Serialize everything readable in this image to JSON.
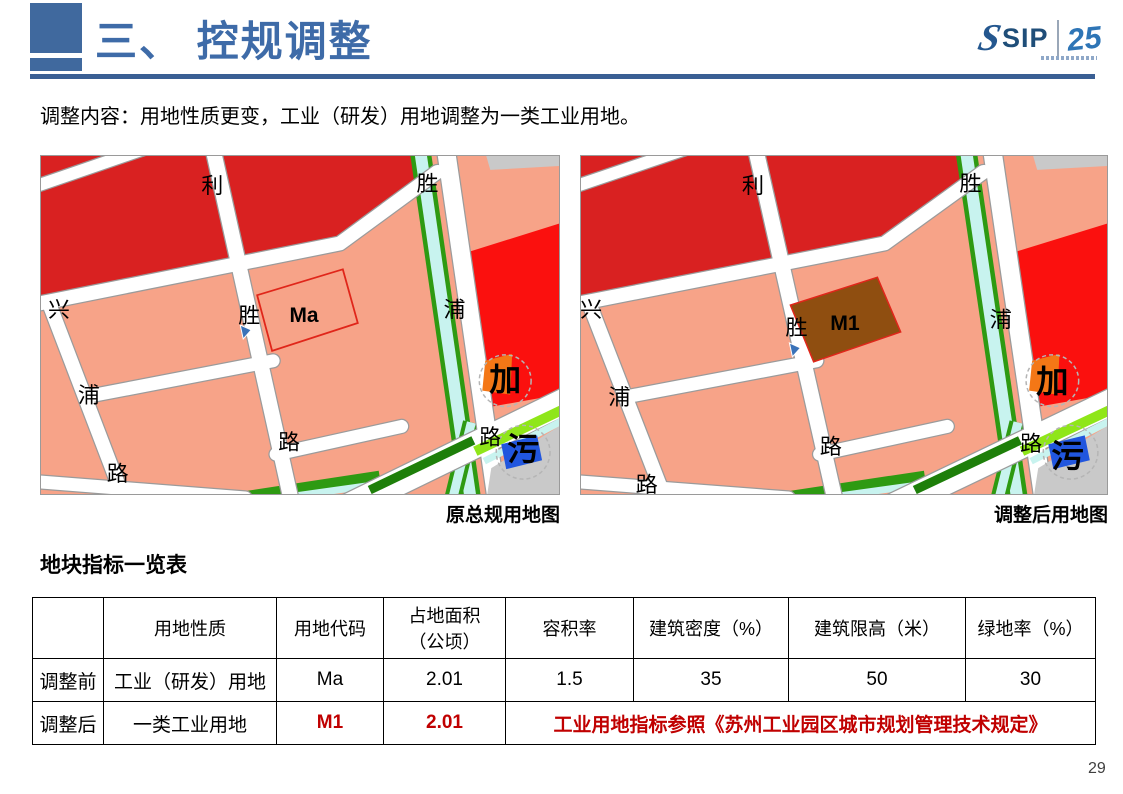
{
  "page": {
    "number": "29"
  },
  "header": {
    "title": "三、 控规调整",
    "accent_color": "#3e6ba8",
    "logo": {
      "sip": "SIP",
      "year": "25",
      "color": "#1f4e79"
    }
  },
  "intro": {
    "text": "调整内容：用地性质更变，工业（研发）用地调整为一类工业用地。"
  },
  "maps": {
    "colors": {
      "industrial_salmon": "#f7a388",
      "commercial_dark_red": "#d92121",
      "commercial_bright_red": "#fb100e",
      "road_white": "#ffffff",
      "road_casing": "#9b9b9b",
      "canal_cyan": "#c8f3ef",
      "green_belt": "#2e9a12",
      "green_belt_dark": "#1e7f0a",
      "green_bright": "#8fe619",
      "gray_area": "#c9c9c9",
      "blue_facility": "#2156de",
      "orange_facility": "#f47716",
      "parcel_outline_red": "#e0261a",
      "parcel_brown": "#8f4e10",
      "marker_blue": "#3a72b8"
    },
    "left": {
      "caption": "原总规用地图",
      "parcel_variant": "outline",
      "labels": [
        {
          "t": "利",
          "x": 172,
          "y": 37,
          "s": 22
        },
        {
          "t": "胜",
          "x": 388,
          "y": 35,
          "s": 22
        },
        {
          "t": "兴",
          "x": 18,
          "y": 162,
          "s": 22
        },
        {
          "t": "胜",
          "x": 209,
          "y": 168,
          "s": 22
        },
        {
          "t": "浦",
          "x": 415,
          "y": 162,
          "s": 22
        },
        {
          "t": "浦",
          "x": 48,
          "y": 248,
          "s": 22
        },
        {
          "t": "路",
          "x": 249,
          "y": 295,
          "s": 22
        },
        {
          "t": "路",
          "x": 77,
          "y": 327,
          "s": 22
        },
        {
          "t": "路",
          "x": 451,
          "y": 290,
          "s": 22
        },
        {
          "t": "加",
          "x": 466,
          "y": 236,
          "s": 32,
          "b": 1
        },
        {
          "t": "污",
          "x": 484,
          "y": 306,
          "s": 32,
          "b": 1
        },
        {
          "t": "Ma",
          "x": 264,
          "y": 167,
          "s": 21,
          "b": 1
        }
      ],
      "marker": {
        "x": 200,
        "y": 170
      }
    },
    "right": {
      "caption": "调整后用地图",
      "parcel_variant": "filled",
      "labels": [
        {
          "t": "利",
          "x": 170,
          "y": 37,
          "s": 22
        },
        {
          "t": "胜",
          "x": 385,
          "y": 35,
          "s": 22
        },
        {
          "t": "兴",
          "x": 10,
          "y": 162,
          "s": 22
        },
        {
          "t": "胜",
          "x": 213,
          "y": 180,
          "s": 22
        },
        {
          "t": "浦",
          "x": 415,
          "y": 172,
          "s": 22
        },
        {
          "t": "浦",
          "x": 38,
          "y": 250,
          "s": 22
        },
        {
          "t": "路",
          "x": 247,
          "y": 300,
          "s": 22
        },
        {
          "t": "路",
          "x": 65,
          "y": 338,
          "s": 22
        },
        {
          "t": "路",
          "x": 445,
          "y": 297,
          "s": 22
        },
        {
          "t": "加",
          "x": 466,
          "y": 238,
          "s": 32,
          "b": 1
        },
        {
          "t": "污",
          "x": 481,
          "y": 313,
          "s": 32,
          "b": 1
        },
        {
          "t": "M1",
          "x": 261,
          "y": 175,
          "s": 21,
          "b": 1
        }
      ],
      "marker": {
        "x": 206,
        "y": 188
      }
    }
  },
  "table": {
    "title": "地块指标一览表",
    "headers": [
      "",
      "用地性质",
      "用地代码",
      "占地面积\n（公顷）",
      "容积率",
      "建筑密度（%）",
      "建筑限高（米）",
      "绿地率（%）"
    ],
    "rows": [
      {
        "label": "调整前",
        "cells": [
          "工业（研发）用地",
          "Ma",
          "2.01",
          "1.5",
          "35",
          "50",
          "30"
        ]
      },
      {
        "label": "调整后",
        "cells": [
          "一类工业用地",
          "M1",
          "2.01"
        ],
        "note": "工业用地指标参照《苏州工业园区城市规划管理技术规定》"
      }
    ],
    "highlight_color": "#c00000"
  }
}
